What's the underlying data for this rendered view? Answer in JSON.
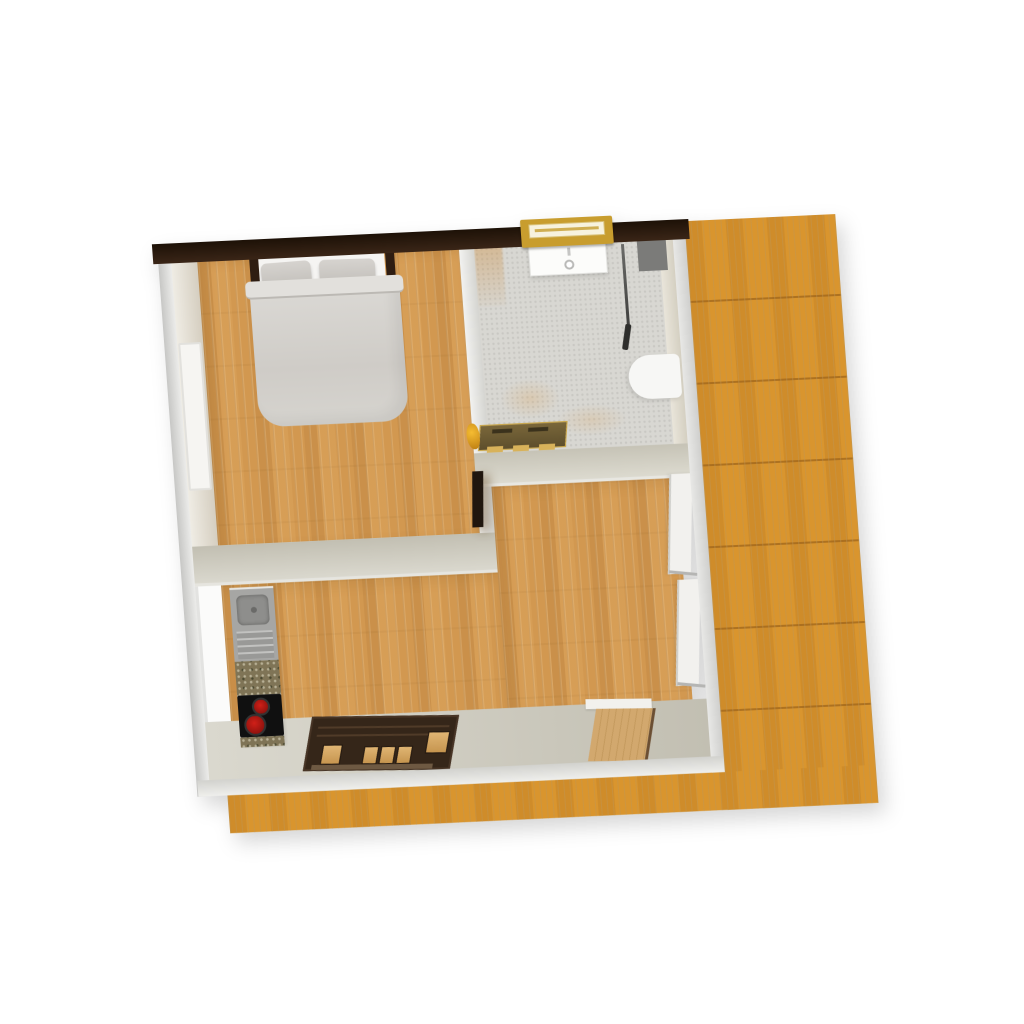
{
  "app": {
    "name": "3d-floor-plan-render",
    "view_mode": "aerial top-down 3D view",
    "visible_text": []
  },
  "palette": {
    "page_bg": "#ffffff",
    "north_wall_dark": "#2e1c10",
    "wall_light_gray": "#d8d8d6",
    "wall_inner_beige": "#d5cec0",
    "interior_wood": "#d29850",
    "deck_wood": "#d9952e",
    "bathroom_tile": "#d8d7d2",
    "duvet_gray": "#d3d1cc",
    "pillow_gray": "#cac7c2",
    "bed_post_brown": "#2e1d12",
    "sideboard_dark": "#352619",
    "sideboard_glass_amber": "#d6a35c",
    "burner_red": "#b51c16",
    "cooktop_black": "#101010",
    "sink_steel": "#a6a6a4",
    "granite_counter": "#7f7456",
    "window_gold": "#c89d2e",
    "radiator_bronze": "#6e5c32",
    "ornament_gold": "#e8a41f",
    "toilet_white": "#f7f7f5",
    "vanity_white": "#fcfcfa",
    "shower_panel_gray": "#7b7b79",
    "patio_door_white": "#f2f1ee",
    "interior_door_white": "#f6f5f2",
    "entry_door_tan": "#c79c63",
    "dark_door_leaf": "#20160e"
  },
  "rooms": [
    {
      "name": "bedroom",
      "floor": "wood parquet",
      "position": "top-left"
    },
    {
      "name": "bathroom",
      "floor": "gray tile",
      "position": "top-right"
    },
    {
      "name": "living-room",
      "floor": "wood parquet",
      "position": "center-bottom"
    },
    {
      "name": "kitchen",
      "floor": "wood parquet",
      "position": "bottom-left strip"
    },
    {
      "name": "deck-terrace",
      "floor": "deck planks",
      "position": "right and bottom outside"
    }
  ],
  "furniture": [
    {
      "name": "double-bed",
      "room": "bedroom",
      "parts": [
        "headboard-posts",
        "two-pillows",
        "gray-duvet"
      ]
    },
    {
      "name": "interior-door",
      "room": "bedroom",
      "wall": "west"
    },
    {
      "name": "vanity-sink",
      "room": "bathroom",
      "wall": "north"
    },
    {
      "name": "window",
      "room": "bathroom",
      "wall": "north"
    },
    {
      "name": "shower-rail",
      "room": "bathroom"
    },
    {
      "name": "shower-panel",
      "room": "bathroom"
    },
    {
      "name": "toilet",
      "room": "bathroom",
      "wall": "east"
    },
    {
      "name": "towel-radiator",
      "room": "bathroom",
      "wall": "south"
    },
    {
      "name": "gold-ornament",
      "room": "bathroom"
    },
    {
      "name": "bathroom-door",
      "room": "living-room",
      "state": "open-dark-leaf"
    },
    {
      "name": "kitchen-sink",
      "room": "kitchen"
    },
    {
      "name": "granite-countertop",
      "room": "kitchen"
    },
    {
      "name": "cooktop-two-burners",
      "room": "kitchen"
    },
    {
      "name": "sideboard-with-glass-doors",
      "room": "living-room",
      "wall": "south"
    },
    {
      "name": "entry-door",
      "room": "living-room",
      "wall": "south",
      "state": "open"
    },
    {
      "name": "patio-doors",
      "room": "living-room",
      "wall": "east",
      "count": 2
    }
  ]
}
